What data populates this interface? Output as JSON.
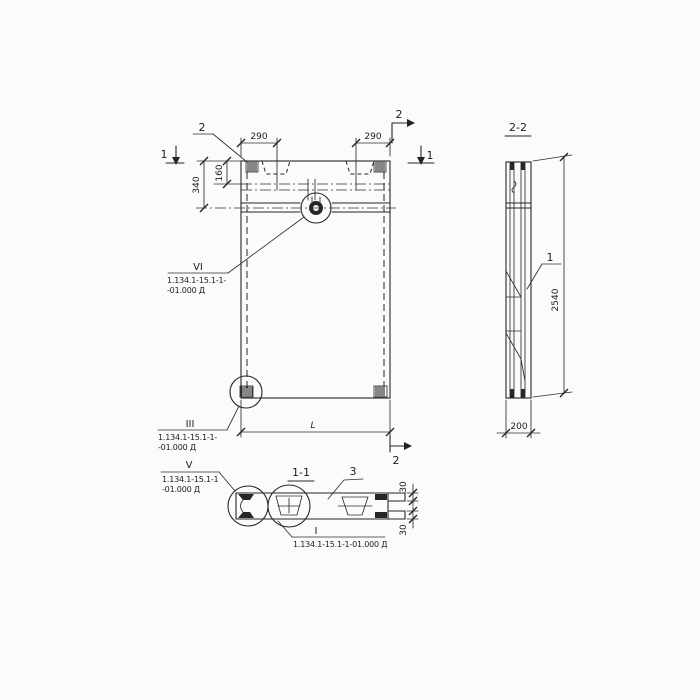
{
  "title": "Precast panel working drawing",
  "colors": {
    "ink": "#262626",
    "paper": "#fbfbfa"
  },
  "front_view": {
    "cut1_left": "1",
    "cut1_right": "1",
    "cut2_top": "2",
    "cut2_bottom": "2",
    "dim_290_left": "290",
    "dim_290_right": "290",
    "dim_160": "160",
    "dim_340": "340",
    "dim_length": "L",
    "label_item2": "2",
    "callout_vi": {
      "num": "VI",
      "line1": "1.134.1-15.1-1-",
      "line2": "-01.000 Д"
    },
    "callout_iii": {
      "num": "III",
      "line1": "1.134.1-15.1-1-",
      "line2": "-01.000 Д"
    }
  },
  "section_2_2": {
    "title": "2-2",
    "label_item1": "1",
    "dim_height": "2540",
    "dim_thickness": "200"
  },
  "section_1_1": {
    "title": "1-1",
    "label_item3": "3",
    "dim_30_top": "30",
    "dim_30_bottom": "30",
    "callout_v": {
      "num": "V",
      "line1": "1.134.1-15.1-1",
      "line2": "-01.000 Д"
    },
    "callout_i": {
      "num": "I",
      "line1": "1.134.1-15.1-1-01.000 Д"
    }
  }
}
